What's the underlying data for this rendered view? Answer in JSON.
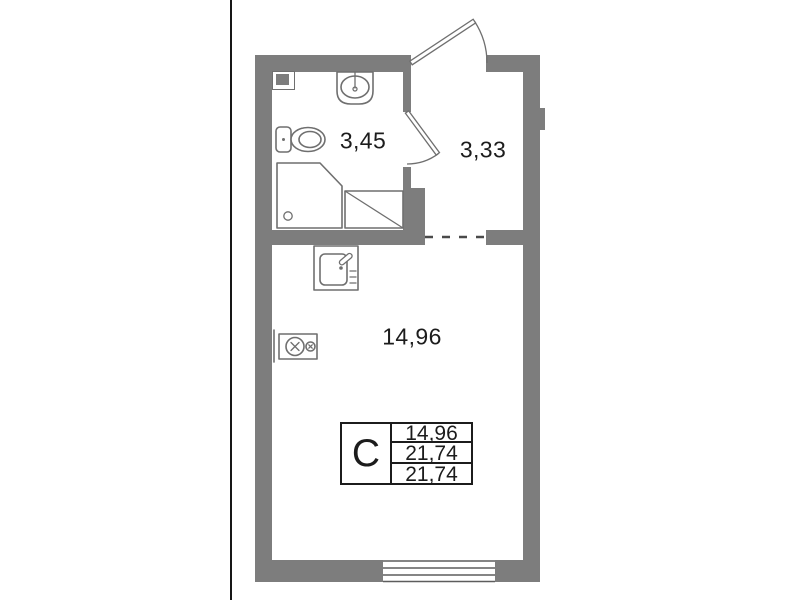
{
  "colors": {
    "wall": "#7d7d7d",
    "line": "#6f6f6f",
    "ink": "#1c1c1c",
    "edge": "#161616",
    "dash": "#4a4a4a",
    "winline": "#5d5d5d"
  },
  "rooms": {
    "bathroom": {
      "area_label": "3,45"
    },
    "hall": {
      "area_label": "3,33"
    },
    "living": {
      "area_label": "14,96"
    }
  },
  "legend": {
    "type_letter": "С",
    "rows": [
      "14,96",
      "21,74",
      "21,74"
    ]
  }
}
